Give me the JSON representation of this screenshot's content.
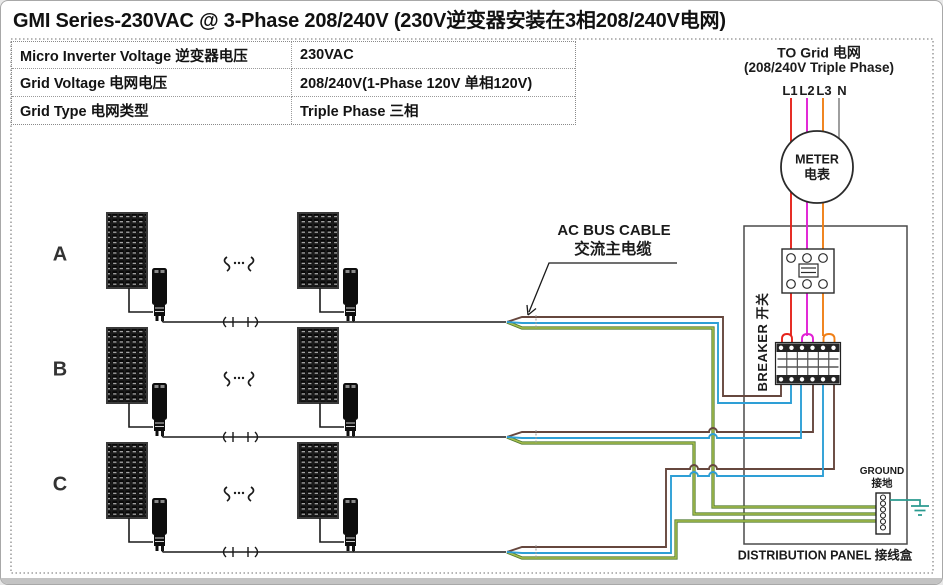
{
  "title": "GMI Series-230VAC @ 3-Phase 208/240V (230V逆变器安装在3相208/240V电网)",
  "spec_table": {
    "rows": [
      {
        "label": "Micro Inverter Voltage 逆变器电压",
        "value": "230VAC"
      },
      {
        "label": "Grid Voltage 电网电压",
        "value": "208/240V(1-Phase 120V 单相120V)"
      },
      {
        "label": "Grid Type 电网类型",
        "value": "Triple Phase 三相"
      }
    ]
  },
  "grid_connection": {
    "heading_line1": "TO Grid 电网",
    "heading_line2": "(208/240V Triple Phase)",
    "phase_labels": [
      "L1",
      "L2",
      "L3",
      "N"
    ]
  },
  "meter": {
    "line1": "METER",
    "line2": "电表"
  },
  "breaker_label": "BREAKER 开关",
  "distribution_panel_label": "DISTRIBUTION PANEL 接线盒",
  "ground_label": {
    "line1": "GROUND",
    "line2": "接地"
  },
  "ac_bus_cable_label": {
    "line1": "AC BUS CABLE",
    "line2": "交流主电缆"
  },
  "branch_rows": [
    {
      "label": "A"
    },
    {
      "label": "B"
    },
    {
      "label": "C"
    }
  ],
  "colors": {
    "phase_l1_red": "#e5231b",
    "phase_l2_magenta": "#e11fd4",
    "phase_l3_orange": "#f07f16",
    "neutral_gray": "#9a9a9a",
    "bus_line_brown": "#66473e",
    "bus_neutral_blue": "#2e9fd6",
    "bus_ground_green": "#a9bf4d",
    "bus_ground_green_dark": "#4f7a30",
    "ground_wire_teal": "#2a9a8f",
    "wire_black": "#1a1a1a"
  }
}
